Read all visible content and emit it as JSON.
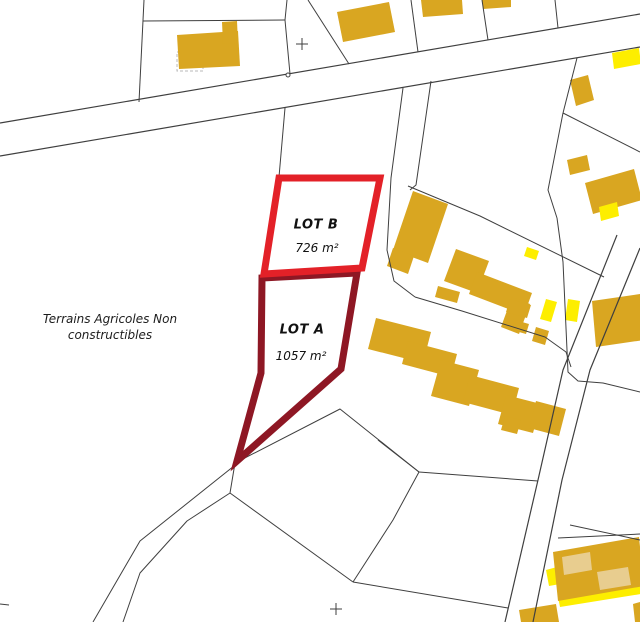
{
  "map": {
    "canvas": {
      "width": 640,
      "height": 622,
      "background": "#ffffff"
    },
    "colors": {
      "gold": "#d9a621",
      "yellow": "#fdee00",
      "light": "#e8cd8f",
      "line": "#3f3f3f",
      "dashed": "#b9b9b9",
      "white": "#ffffff"
    },
    "lots": [
      {
        "id": "lot-a",
        "label": "LOT A",
        "area": "1057 m²",
        "color": "#8e1724",
        "stroke_width": 7,
        "points": [
          [
            262,
            278
          ],
          [
            357,
            273
          ],
          [
            341,
            369
          ],
          [
            237,
            461
          ],
          [
            261,
            373
          ]
        ]
      },
      {
        "id": "lot-b",
        "label": "LOT B",
        "area": "726 m²",
        "color": "#e32128",
        "stroke_width": 7,
        "points": [
          [
            279,
            178
          ],
          [
            380,
            178
          ],
          [
            362,
            268
          ],
          [
            264,
            274
          ]
        ]
      }
    ],
    "note": {
      "line1": "Terrains Agricoles Non",
      "line2": "constructibles"
    },
    "buildings": [
      {
        "fill": "gold",
        "points": [
          [
            177,
            35
          ],
          [
            238,
            31
          ],
          [
            240,
            66
          ],
          [
            179,
            69
          ]
        ]
      },
      {
        "fill": "gold",
        "points": [
          [
            222,
            22
          ],
          [
            237,
            21
          ],
          [
            238,
            43
          ],
          [
            223,
            44
          ]
        ]
      },
      {
        "fill": "gold",
        "points": [
          [
            337,
            12
          ],
          [
            389,
            2
          ],
          [
            395,
            32
          ],
          [
            343,
            42
          ]
        ]
      },
      {
        "fill": "gold",
        "points": [
          [
            421,
            0
          ],
          [
            462,
            0
          ],
          [
            463,
            14
          ],
          [
            423,
            17
          ]
        ]
      },
      {
        "fill": "gold",
        "points": [
          [
            482,
            0
          ],
          [
            511,
            0
          ],
          [
            511,
            7
          ],
          [
            483,
            9
          ]
        ]
      },
      {
        "fill": "yellow",
        "points": [
          [
            612,
            53
          ],
          [
            639,
            48
          ],
          [
            641,
            64
          ],
          [
            614,
            69
          ]
        ]
      },
      {
        "fill": "gold",
        "points": [
          [
            570,
            80
          ],
          [
            588,
            75
          ],
          [
            594,
            100
          ],
          [
            576,
            106
          ]
        ]
      },
      {
        "fill": "gold",
        "points": [
          [
            567,
            160
          ],
          [
            587,
            155
          ],
          [
            590,
            170
          ],
          [
            570,
            175
          ]
        ]
      },
      {
        "fill": "gold",
        "points": [
          [
            585,
            183
          ],
          [
            634,
            169
          ],
          [
            642,
            200
          ],
          [
            593,
            214
          ]
        ]
      },
      {
        "fill": "yellow",
        "points": [
          [
            599,
            207
          ],
          [
            617,
            202
          ],
          [
            619,
            216
          ],
          [
            601,
            221
          ]
        ]
      },
      {
        "fill": "gold",
        "points": [
          [
            413,
            191
          ],
          [
            448,
            204
          ],
          [
            428,
            263
          ],
          [
            393,
            250
          ]
        ]
      },
      {
        "fill": "gold",
        "points": [
          [
            393,
            248
          ],
          [
            414,
            256
          ],
          [
            408,
            274
          ],
          [
            387,
            266
          ]
        ]
      },
      {
        "fill": "gold",
        "points": [
          [
            438,
            286
          ],
          [
            460,
            292
          ],
          [
            457,
            303
          ],
          [
            435,
            297
          ]
        ]
      },
      {
        "fill": "yellow",
        "points": [
          [
            527,
            247
          ],
          [
            539,
            251
          ],
          [
            536,
            260
          ],
          [
            524,
            256
          ]
        ]
      },
      {
        "fill": "gold",
        "points": [
          [
            456,
            249
          ],
          [
            489,
            261
          ],
          [
            477,
            293
          ],
          [
            444,
            281
          ]
        ]
      },
      {
        "fill": "gold",
        "points": [
          [
            477,
            272
          ],
          [
            532,
            293
          ],
          [
            524,
            315
          ],
          [
            469,
            294
          ]
        ]
      },
      {
        "fill": "gold",
        "points": [
          [
            512,
            297
          ],
          [
            530,
            304
          ],
          [
            519,
            334
          ],
          [
            501,
            327
          ]
        ]
      },
      {
        "fill": "gold",
        "points": [
          [
            510,
            299
          ],
          [
            531,
            305
          ],
          [
            527,
            318
          ],
          [
            506,
            312
          ]
        ]
      },
      {
        "fill": "gold",
        "points": [
          [
            515,
            320
          ],
          [
            529,
            324
          ],
          [
            526,
            334
          ],
          [
            512,
            330
          ]
        ]
      },
      {
        "fill": "yellow",
        "points": [
          [
            546,
            299
          ],
          [
            557,
            302
          ],
          [
            551,
            322
          ],
          [
            540,
            319
          ]
        ]
      },
      {
        "fill": "yellow",
        "points": [
          [
            568,
            299
          ],
          [
            580,
            301
          ],
          [
            577,
            322
          ],
          [
            565,
            320
          ]
        ]
      },
      {
        "fill": "gold",
        "points": [
          [
            592,
            301
          ],
          [
            640,
            294
          ],
          [
            644,
            340
          ],
          [
            596,
            347
          ]
        ]
      },
      {
        "fill": "gold",
        "points": [
          [
            536,
            327
          ],
          [
            549,
            331
          ],
          [
            545,
            345
          ],
          [
            532,
            341
          ]
        ]
      },
      {
        "fill": "gold",
        "points": [
          [
            376,
            318
          ],
          [
            431,
            332
          ],
          [
            423,
            363
          ],
          [
            368,
            349
          ]
        ]
      },
      {
        "fill": "gold",
        "points": [
          [
            408,
            341
          ],
          [
            457,
            354
          ],
          [
            451,
            377
          ],
          [
            402,
            364
          ]
        ]
      },
      {
        "fill": "gold",
        "points": [
          [
            441,
            360
          ],
          [
            479,
            370
          ],
          [
            469,
            406
          ],
          [
            431,
            396
          ]
        ]
      },
      {
        "fill": "gold",
        "points": [
          [
            470,
            375
          ],
          [
            519,
            388
          ],
          [
            512,
            415
          ],
          [
            463,
            402
          ]
        ]
      },
      {
        "fill": "gold",
        "points": [
          [
            506,
            395
          ],
          [
            541,
            404
          ],
          [
            533,
            433
          ],
          [
            498,
            424
          ]
        ]
      },
      {
        "fill": "gold",
        "points": [
          [
            536,
            401
          ],
          [
            566,
            409
          ],
          [
            559,
            436
          ],
          [
            529,
            428
          ]
        ]
      },
      {
        "fill": "gold",
        "points": [
          [
            505,
            416
          ],
          [
            521,
            420
          ],
          [
            517,
            434
          ],
          [
            501,
            430
          ]
        ]
      },
      {
        "fill": "yellow",
        "points": [
          [
            546,
            570
          ],
          [
            557,
            567
          ],
          [
            560,
            584
          ],
          [
            549,
            586
          ]
        ]
      },
      {
        "fill": "yellow",
        "points": [
          [
            558,
            597
          ],
          [
            640,
            583
          ],
          [
            641,
            594
          ],
          [
            560,
            607
          ]
        ]
      },
      {
        "fill": "gold",
        "points": [
          [
            553,
            552
          ],
          [
            639,
            537
          ],
          [
            644,
            586
          ],
          [
            558,
            601
          ]
        ]
      },
      {
        "fill": "light",
        "points": [
          [
            562,
            557
          ],
          [
            590,
            552
          ],
          [
            592,
            570
          ],
          [
            564,
            575
          ]
        ]
      },
      {
        "fill": "light",
        "points": [
          [
            597,
            572
          ],
          [
            628,
            567
          ],
          [
            631,
            585
          ],
          [
            600,
            590
          ]
        ]
      },
      {
        "fill": "gold",
        "points": [
          [
            519,
            610
          ],
          [
            556,
            604
          ],
          [
            559,
            622
          ],
          [
            521,
            622
          ]
        ]
      },
      {
        "fill": "gold",
        "points": [
          [
            633,
            604
          ],
          [
            640,
            602
          ],
          [
            640,
            622
          ],
          [
            635,
            622
          ]
        ]
      }
    ],
    "dashed_outlines": [
      {
        "points": [
          [
            177,
            52
          ],
          [
            203,
            52
          ],
          [
            203,
            71
          ],
          [
            177,
            71
          ]
        ]
      }
    ],
    "parcel_lines": [
      {
        "points": [
          [
            144,
            0
          ],
          [
            139,
            102
          ]
        ]
      },
      {
        "points": [
          [
            287,
            0
          ],
          [
            285,
            20
          ],
          [
            290,
            74
          ]
        ]
      },
      {
        "points": [
          [
            143,
            21
          ],
          [
            285,
            20
          ]
        ]
      },
      {
        "points": [
          [
            308,
            0
          ],
          [
            349,
            64
          ]
        ]
      },
      {
        "points": [
          [
            411,
            0
          ],
          [
            418,
            52
          ]
        ]
      },
      {
        "points": [
          [
            482,
            0
          ],
          [
            488,
            40
          ]
        ]
      },
      {
        "points": [
          [
            555,
            0
          ],
          [
            558,
            28
          ]
        ]
      },
      {
        "points": [
          [
            577,
            58
          ],
          [
            563,
            113
          ]
        ]
      },
      {
        "points": [
          [
            563,
            113
          ],
          [
            640,
            152
          ]
        ]
      },
      {
        "points": [
          [
            563,
            113
          ],
          [
            548,
            190
          ],
          [
            557,
            218
          ]
        ]
      },
      {
        "points": [
          [
            408,
            186
          ],
          [
            480,
            216
          ],
          [
            604,
            277
          ]
        ]
      },
      {
        "points": [
          [
            403,
            88
          ],
          [
            391,
            178
          ],
          [
            387,
            250
          ],
          [
            394,
            281
          ],
          [
            415,
            297
          ]
        ]
      },
      {
        "points": [
          [
            431,
            81
          ],
          [
            416,
            185
          ],
          [
            410,
            190
          ]
        ]
      },
      {
        "points": [
          [
            415,
            297
          ],
          [
            462,
            311
          ],
          [
            545,
            337
          ],
          [
            566,
            352
          ],
          [
            571,
            367
          ]
        ]
      },
      {
        "points": [
          [
            557,
            218
          ],
          [
            563,
            262
          ],
          [
            568,
            372
          ],
          [
            578,
            381
          ],
          [
            603,
            383
          ],
          [
            640,
            392
          ]
        ]
      },
      {
        "points": [
          [
            285,
            108
          ],
          [
            279,
            177
          ]
        ]
      },
      {
        "points": [
          [
            237,
            462
          ],
          [
            340,
            409
          ],
          [
            419,
            472
          ]
        ]
      },
      {
        "points": [
          [
            419,
            472
          ],
          [
            538,
            481
          ]
        ]
      },
      {
        "points": [
          [
            378,
            440
          ],
          [
            419,
            472
          ]
        ]
      },
      {
        "points": [
          [
            419,
            472
          ],
          [
            393,
            520
          ],
          [
            353,
            582
          ]
        ]
      },
      {
        "points": [
          [
            230,
            493
          ],
          [
            353,
            582
          ]
        ]
      },
      {
        "points": [
          [
            353,
            582
          ],
          [
            508,
            608
          ]
        ]
      },
      {
        "points": [
          [
            235,
            463
          ],
          [
            230,
            493
          ]
        ]
      },
      {
        "points": [
          [
            234,
            466
          ],
          [
            140,
            541
          ],
          [
            93,
            622
          ]
        ]
      },
      {
        "points": [
          [
            230,
            493
          ],
          [
            187,
            521
          ],
          [
            140,
            573
          ],
          [
            123,
            622
          ]
        ]
      },
      {
        "points": [
          [
            570,
            525
          ],
          [
            640,
            540
          ]
        ]
      },
      {
        "points": [
          [
            558,
            538
          ],
          [
            640,
            534
          ]
        ]
      },
      {
        "points": [
          [
            0,
            604
          ],
          [
            9,
            605
          ]
        ]
      }
    ],
    "roads": [
      {
        "points": [
          [
            0,
            123
          ],
          [
            640,
            14
          ]
        ]
      },
      {
        "points": [
          [
            0,
            156
          ],
          [
            640,
            47
          ]
        ]
      },
      {
        "points": [
          [
            617,
            235
          ],
          [
            563,
            370
          ],
          [
            538,
            480
          ],
          [
            505,
            622
          ]
        ]
      },
      {
        "points": [
          [
            640,
            248
          ],
          [
            590,
            370
          ],
          [
            562,
            480
          ],
          [
            533,
            622
          ]
        ]
      }
    ],
    "survey_crosses": [
      [
        302,
        44
      ],
      [
        336,
        609
      ]
    ],
    "survey_points": [
      [
        288,
        75
      ]
    ]
  }
}
